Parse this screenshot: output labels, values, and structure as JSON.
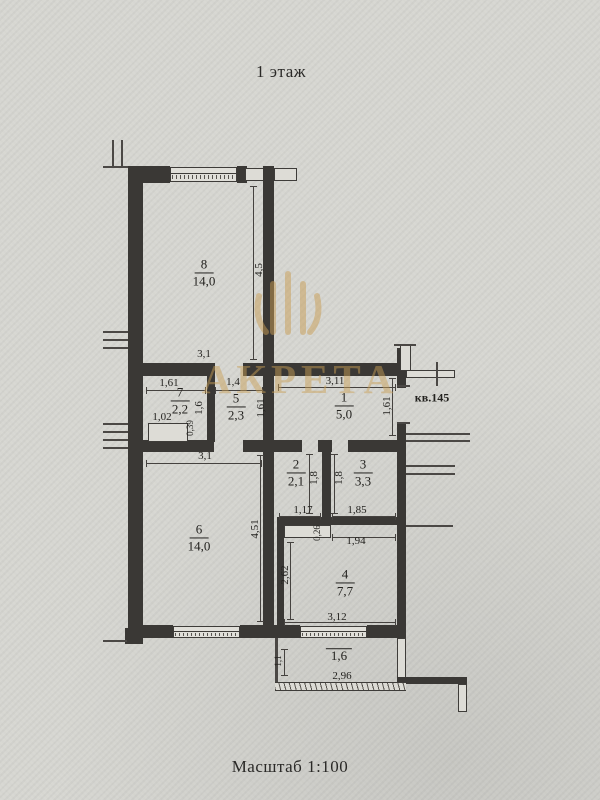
{
  "meta": {
    "floor_label": "1 этаж",
    "scale_label": "Масштаб 1:100",
    "watermark_text": "АКРЕТА",
    "paper_color": "#d6d6d1",
    "ink_color": "#3a3835",
    "watermark_color": "#c99e55"
  },
  "plan": {
    "rooms": [
      {
        "num": "8",
        "area": "14,0",
        "x": 204,
        "y": 273
      },
      {
        "num": "7",
        "area": "2,2",
        "x": 180,
        "y": 401
      },
      {
        "num": "5",
        "area": "2,3",
        "x": 236,
        "y": 407
      },
      {
        "num": "1",
        "area": "5,0",
        "x": 344,
        "y": 406
      },
      {
        "num": "2",
        "area": "2,1",
        "x": 296,
        "y": 473
      },
      {
        "num": "3",
        "area": "3,3",
        "x": 363,
        "y": 473
      },
      {
        "num": "6",
        "area": "14,0",
        "x": 199,
        "y": 538
      },
      {
        "num": "4",
        "area": "7,7",
        "x": 345,
        "y": 583
      },
      {
        "num": "",
        "area": "1,6",
        "x": 339,
        "y": 656
      }
    ],
    "dims": [
      {
        "t": "3,1",
        "x": 204,
        "y": 354,
        "name": "dim-room8-width"
      },
      {
        "t": "1,61",
        "x": 169,
        "y": 383,
        "name": "dim-room7-width"
      },
      {
        "t": "1,4",
        "x": 233,
        "y": 382,
        "name": "dim-room5-width"
      },
      {
        "t": "3,11",
        "x": 335,
        "y": 381,
        "name": "dim-room1-width"
      },
      {
        "t": "кв.145",
        "x": 432,
        "y": 398,
        "apt": true,
        "name": "apartment-number-label"
      },
      {
        "t": "1,02",
        "x": 162,
        "y": 417,
        "name": "dim-niche-width"
      },
      {
        "t": "3,1",
        "x": 205,
        "y": 456,
        "name": "dim-room6-width"
      },
      {
        "t": "1,17",
        "x": 303,
        "y": 510,
        "name": "dim-room2-width"
      },
      {
        "t": "1,85",
        "x": 357,
        "y": 510,
        "name": "dim-room3-width"
      },
      {
        "t": "1,94",
        "x": 356,
        "y": 541,
        "name": "dim-room4-top-width"
      },
      {
        "t": "3,12",
        "x": 337,
        "y": 617,
        "name": "dim-room4-width"
      },
      {
        "t": "2,96",
        "x": 342,
        "y": 676,
        "name": "dim-balcony-width"
      },
      {
        "t": "4,5",
        "x": 259,
        "y": 270,
        "rot": true,
        "name": "dim-room8-height"
      },
      {
        "t": "1,6",
        "x": 199,
        "y": 408,
        "rot": true,
        "name": "dim-room7-height"
      },
      {
        "t": "0,39",
        "x": 190,
        "y": 428,
        "rot": true,
        "small": true,
        "name": "dim-niche-depth"
      },
      {
        "t": "1,61",
        "x": 261,
        "y": 408,
        "rot": true,
        "name": "dim-room5-height"
      },
      {
        "t": "1,61",
        "x": 387,
        "y": 406,
        "rot": true,
        "name": "dim-room1-height"
      },
      {
        "t": "1,8",
        "x": 314,
        "y": 478,
        "rot": true,
        "name": "dim-room2-height"
      },
      {
        "t": "1,8",
        "x": 339,
        "y": 478,
        "rot": true,
        "name": "dim-room3-height"
      },
      {
        "t": "4,51",
        "x": 255,
        "y": 529,
        "rot": true,
        "name": "dim-room6-height"
      },
      {
        "t": "0,26",
        "x": 317,
        "y": 533,
        "rot": true,
        "small": true,
        "name": "dim-duct-offset"
      },
      {
        "t": "2,62",
        "x": 285,
        "y": 575,
        "rot": true,
        "name": "dim-room4-height"
      },
      {
        "t": "1,1",
        "x": 278,
        "y": 661,
        "rot": true,
        "small": true,
        "name": "dim-balcony-depth"
      }
    ],
    "elements": [
      {
        "kind": "wall",
        "name": "top-wall-left",
        "rect": [
          128,
          166,
          42,
          17
        ]
      },
      {
        "kind": "window",
        "name": "room8-window",
        "rect": [
          170,
          167,
          67,
          15
        ]
      },
      {
        "kind": "wall",
        "name": "top-wall-mid",
        "rect": [
          237,
          166,
          10,
          17
        ]
      },
      {
        "kind": "outline",
        "name": "top-wall-pier",
        "rect": [
          245,
          168,
          19,
          13
        ]
      },
      {
        "kind": "wall",
        "name": "top-wall-right",
        "rect": [
          263,
          166,
          11,
          17
        ]
      },
      {
        "kind": "outline",
        "name": "neighbor-wall-stub-top",
        "rect": [
          274,
          168,
          23,
          13
        ]
      },
      {
        "kind": "wall",
        "name": "outer-wall-left",
        "rect": [
          128,
          166,
          15,
          462
        ]
      },
      {
        "kind": "wall",
        "name": "central-wall",
        "rect": [
          263,
          183,
          11,
          445
        ]
      },
      {
        "kind": "wall",
        "name": "hall-top-wall-left",
        "rect": [
          128,
          363,
          87,
          13
        ]
      },
      {
        "kind": "wall",
        "name": "hall-top-wall-right",
        "rect": [
          243,
          363,
          163,
          13
        ]
      },
      {
        "kind": "wall",
        "name": "wall-room7-room5",
        "rect": [
          207,
          376,
          8,
          66
        ]
      },
      {
        "kind": "wall",
        "name": "hall-bottom-wall-a",
        "rect": [
          128,
          440,
          86,
          12
        ]
      },
      {
        "kind": "wall",
        "name": "hall-bottom-wall-b",
        "rect": [
          243,
          440,
          59,
          12
        ]
      },
      {
        "kind": "wall",
        "name": "hall-bottom-wall-c",
        "rect": [
          318,
          440,
          14,
          12
        ]
      },
      {
        "kind": "wall",
        "name": "hall-bottom-wall-d",
        "rect": [
          348,
          440,
          58,
          12
        ]
      },
      {
        "kind": "wall",
        "name": "outer-wall-right-top",
        "rect": [
          397,
          348,
          9,
          40
        ]
      },
      {
        "kind": "wall",
        "name": "outer-wall-right-main",
        "rect": [
          397,
          423,
          9,
          215
        ]
      },
      {
        "kind": "wall",
        "name": "wall-room2-room3",
        "rect": [
          322,
          452,
          9,
          72
        ]
      },
      {
        "kind": "wall",
        "name": "rooms23-bottom-wall",
        "rect": [
          277,
          517,
          123,
          8
        ]
      },
      {
        "kind": "wall",
        "name": "room4-left-wall",
        "rect": [
          277,
          517,
          7,
          111
        ]
      },
      {
        "kind": "outline",
        "name": "duct-under-room2",
        "rect": [
          284,
          525,
          47,
          13
        ]
      },
      {
        "kind": "outline",
        "name": "room7-niche",
        "rect": [
          148,
          423,
          40,
          19
        ]
      },
      {
        "kind": "wall",
        "name": "bottom-wall-left",
        "rect": [
          128,
          625,
          45,
          13
        ]
      },
      {
        "kind": "window",
        "name": "room6-window",
        "rect": [
          173,
          626,
          67,
          12
        ]
      },
      {
        "kind": "wall",
        "name": "bottom-wall-mid",
        "rect": [
          240,
          625,
          60,
          13
        ]
      },
      {
        "kind": "window",
        "name": "room4-balcony-window",
        "rect": [
          300,
          626,
          67,
          12
        ]
      },
      {
        "kind": "wall",
        "name": "bottom-wall-right",
        "rect": [
          367,
          625,
          30,
          13
        ]
      },
      {
        "kind": "wall",
        "name": "bottom-left-step",
        "rect": [
          125,
          628,
          18,
          16
        ]
      },
      {
        "kind": "outline",
        "name": "outer-wall-right-low",
        "rect": [
          397,
          638,
          9,
          40
        ]
      },
      {
        "kind": "wall",
        "name": "bottom-right-jog",
        "rect": [
          397,
          677,
          70,
          7
        ]
      },
      {
        "kind": "outline",
        "name": "bottom-right-stub",
        "rect": [
          458,
          684,
          9,
          28
        ]
      },
      {
        "kind": "outline",
        "name": "corridor-top-wall",
        "rect": [
          406,
          370,
          49,
          8
        ]
      },
      {
        "kind": "outline",
        "name": "corridor-vert-wall",
        "rect": [
          400,
          345,
          11,
          26
        ]
      },
      {
        "kind": "tline",
        "name": "corridor-cross-tick",
        "rect": [
          436,
          362,
          2,
          24
        ]
      },
      {
        "kind": "tline",
        "name": "corridor-top-cap",
        "rect": [
          394,
          344,
          22,
          2
        ]
      },
      {
        "kind": "tline",
        "name": "entry-door-jamb-top",
        "rect": [
          397,
          385,
          13,
          2
        ]
      },
      {
        "kind": "tline",
        "name": "entry-door-jamb-bottom",
        "rect": [
          397,
          422,
          13,
          2
        ]
      },
      {
        "kind": "tline",
        "name": "left-stub-vert-a",
        "rect": [
          112,
          140,
          2,
          27
        ]
      },
      {
        "kind": "tline",
        "name": "left-stub-vert-b",
        "rect": [
          121,
          140,
          2,
          27
        ]
      },
      {
        "kind": "tline",
        "name": "left-stub-top-edge",
        "rect": [
          103,
          166,
          25,
          2
        ]
      },
      {
        "kind": "tline",
        "name": "left-stub-1a",
        "rect": [
          103,
          331,
          25,
          2
        ]
      },
      {
        "kind": "tline",
        "name": "left-stub-1b",
        "rect": [
          103,
          339,
          25,
          2
        ]
      },
      {
        "kind": "tline",
        "name": "left-stub-1c",
        "rect": [
          103,
          347,
          25,
          2
        ]
      },
      {
        "kind": "tline",
        "name": "left-stub-2a",
        "rect": [
          103,
          423,
          25,
          2
        ]
      },
      {
        "kind": "tline",
        "name": "left-stub-2b",
        "rect": [
          103,
          431,
          25,
          2
        ]
      },
      {
        "kind": "tline",
        "name": "left-stub-2c",
        "rect": [
          103,
          439,
          25,
          2
        ]
      },
      {
        "kind": "tline",
        "name": "left-stub-2d",
        "rect": [
          103,
          447,
          25,
          2
        ]
      },
      {
        "kind": "tline",
        "name": "left-stub-bottom",
        "rect": [
          103,
          640,
          24,
          2
        ]
      },
      {
        "kind": "tline",
        "name": "right-stub-1a",
        "rect": [
          406,
          433,
          64,
          2
        ]
      },
      {
        "kind": "tline",
        "name": "right-stub-1b",
        "rect": [
          406,
          440,
          64,
          2
        ]
      },
      {
        "kind": "tline",
        "name": "right-stub-2a",
        "rect": [
          406,
          465,
          49,
          2
        ]
      },
      {
        "kind": "tline",
        "name": "right-stub-2b",
        "rect": [
          406,
          473,
          49,
          2
        ]
      },
      {
        "kind": "tline",
        "name": "right-stub-3",
        "rect": [
          406,
          525,
          47,
          2
        ]
      },
      {
        "kind": "tline",
        "name": "balcony-left-wall",
        "rect": [
          275,
          638,
          3,
          50
        ]
      },
      {
        "kind": "rail",
        "name": "balcony-railing",
        "rect": [
          275,
          682,
          131,
          9
        ]
      },
      {
        "kind": "dlh",
        "name": "dimline-room7-top",
        "rect": [
          146,
          390,
          60,
          1
        ]
      },
      {
        "kind": "dlh",
        "name": "dimline-room5-top",
        "rect": [
          215,
          390,
          48,
          1
        ]
      },
      {
        "kind": "dlh",
        "name": "dimline-room1-top",
        "rect": [
          278,
          387,
          118,
          1
        ]
      },
      {
        "kind": "dlh",
        "name": "dimline-room6-top",
        "rect": [
          146,
          463,
          116,
          1
        ]
      },
      {
        "kind": "dlh",
        "name": "dimline-room2-bottom",
        "rect": [
          279,
          516,
          42,
          1
        ]
      },
      {
        "kind": "dlh",
        "name": "dimline-room3-bottom",
        "rect": [
          332,
          516,
          64,
          1
        ]
      },
      {
        "kind": "dlh",
        "name": "dimline-room4-top",
        "rect": [
          332,
          537,
          64,
          1
        ]
      },
      {
        "kind": "dlh",
        "name": "dimline-room4-bottom",
        "rect": [
          284,
          622,
          112,
          1
        ]
      },
      {
        "kind": "dlv",
        "name": "dimline-room8-height",
        "rect": [
          253,
          186,
          1,
          174
        ]
      },
      {
        "kind": "dlv",
        "name": "dimline-room1-height",
        "rect": [
          392,
          378,
          1,
          58
        ]
      },
      {
        "kind": "dlv",
        "name": "dimline-room2-height",
        "rect": [
          309,
          454,
          1,
          60
        ]
      },
      {
        "kind": "dlv",
        "name": "dimline-room3-height",
        "rect": [
          334,
          454,
          1,
          60
        ]
      },
      {
        "kind": "dlv",
        "name": "dimline-room6-height",
        "rect": [
          260,
          455,
          1,
          167
        ]
      },
      {
        "kind": "dlv",
        "name": "dimline-room4-height",
        "rect": [
          290,
          542,
          1,
          78
        ]
      },
      {
        "kind": "dlv",
        "name": "dimline-balcony-depth",
        "rect": [
          284,
          649,
          1,
          27
        ]
      }
    ]
  }
}
